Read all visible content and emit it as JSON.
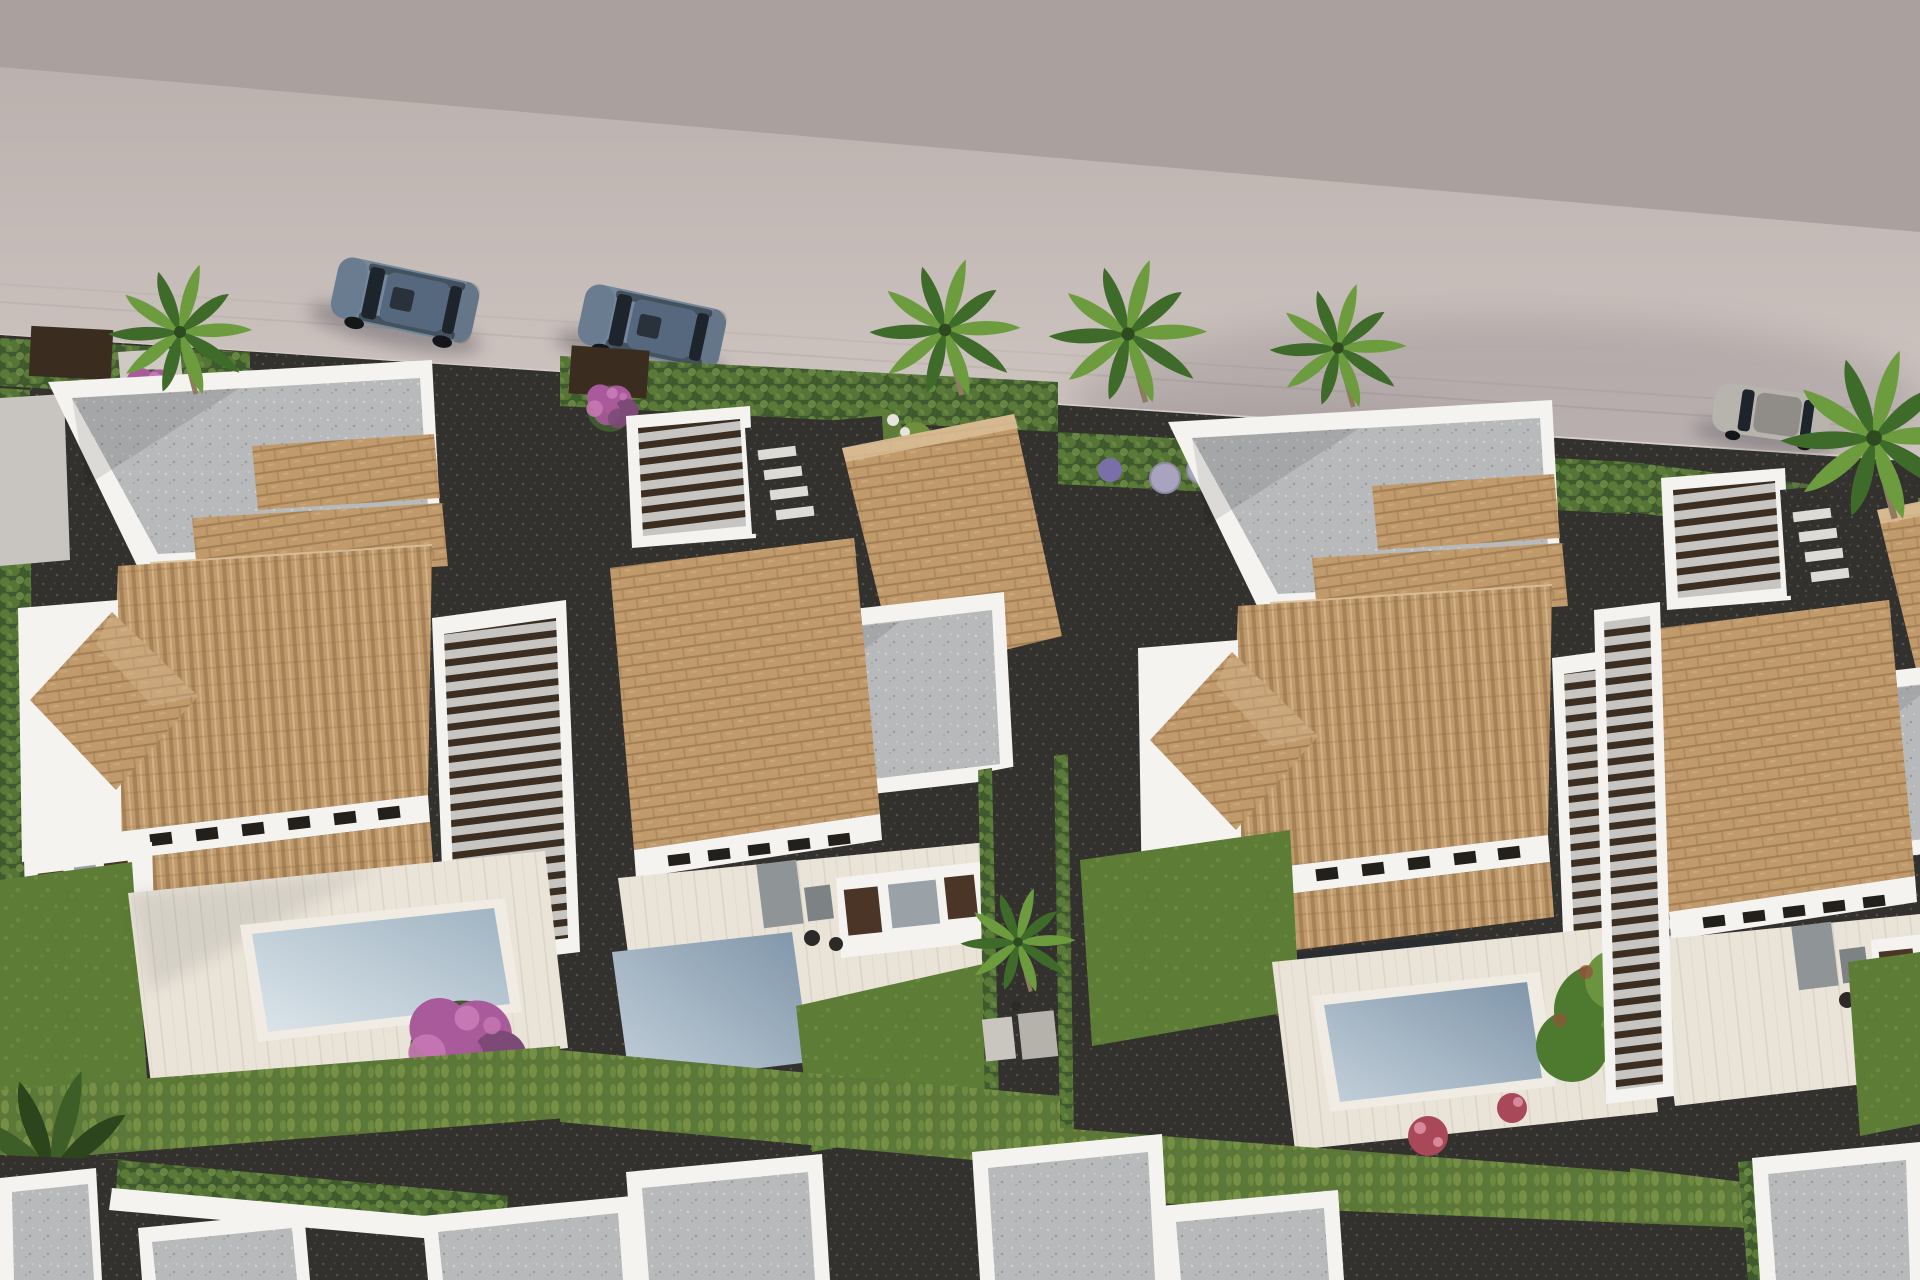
{
  "scene": {
    "type": "photorealistic-3d-architectural-render",
    "view": "aerial-oblique",
    "subject": "Row of modern white villas with terracotta tiled roofs, wooden pergolas, private pools, lawns, cypress hedges, palm trees and flowering shrubs; empty grey street with parked cars along the top; next row of white flat-roofed houses at the bottom edge",
    "lighting": "daylight, sun from upper right, soft shadows toward lower left"
  },
  "inventory": {
    "villas_visible": 4,
    "pools_visible": 4,
    "cars": [
      {
        "type": "suv",
        "color_name": "steel-blue",
        "location": "street-top-left"
      },
      {
        "type": "suv",
        "color_name": "steel-blue",
        "location": "street-top-left-2"
      },
      {
        "type": "sedan",
        "color_name": "silver-grey",
        "location": "street-top-right"
      }
    ],
    "palm_trees": 7,
    "vegetation": [
      "cypress-hedges",
      "lawns",
      "purple-bougainvillea",
      "white-and-purple-flower-beds",
      "red-flower-shrubs",
      "green-tree",
      "banana-plants"
    ],
    "hardscape": [
      "tiled-roofs",
      "pergola-slat-roofs",
      "white-parapet-terraces",
      "wood-look-pool-decks",
      "dark-gravel-paths",
      "stepping-stones",
      "outdoor-shower-mats",
      "sun-loungers"
    ]
  },
  "palette": {
    "street_far": "#aaa19f",
    "street_top": "#b7aeab",
    "street_bottom": "#d2c8c4",
    "curb": "#d9d2cc",
    "ground_dark": "#33312d",
    "path_speck": "#5a574f",
    "wall_white": "#f4f3f0",
    "wall_shade": "#dddad5",
    "terrace_gray": "#b7b9ba",
    "terrace_speck": "#8f9193",
    "roof_tile": "#c19a6b",
    "roof_tile_dark": "#8a6a45",
    "roof_tile_light": "#dcc09a",
    "slat_brown": "#3c2f22",
    "slat_base": "#c7c5c1",
    "door_brown": "#4a3526",
    "curtain_gray": "#9aa2a8",
    "glazing": "#2a2d31",
    "deck": "#e9e3d8",
    "deck_line": "#cfc6b8",
    "pool_deep": "#7f95a9",
    "pool_light": "#c3d0da",
    "pool1_deep": "#9fb3c2",
    "pool1_light": "#dce5ea",
    "pool_rim": "#f0ece4",
    "grass": "#5d7d36",
    "grass_light": "#7a9a4a",
    "hedge_dark": "#3f5a2c",
    "hedge_mid": "#5a7a38",
    "hedge_light": "#78984c",
    "cypress_dark": "#5c7737",
    "cypress_light": "#8aa450",
    "palm_green": "#6d9c3f",
    "palm_dark": "#3f6b2a",
    "trunk": "#8d7c5f",
    "bougainvillea": "#a85a9a",
    "bougainvillea_light": "#c678b4",
    "bougainvillea_dark": "#7d4a78",
    "flower_red": "#a84858",
    "flower_red_light": "#d8889c",
    "tree_green": "#4e7a30",
    "tree_green_light": "#6a9440",
    "tree_red": "#9c4c3c",
    "ball_gray": "#a8a4be",
    "car_blue": "#74879c",
    "car_blue_dark": "#55687d",
    "car_glass": "#1e242b",
    "car_silver": "#b7b4ae",
    "car_silver_dark": "#908d88",
    "shadow": "#3c3844"
  }
}
